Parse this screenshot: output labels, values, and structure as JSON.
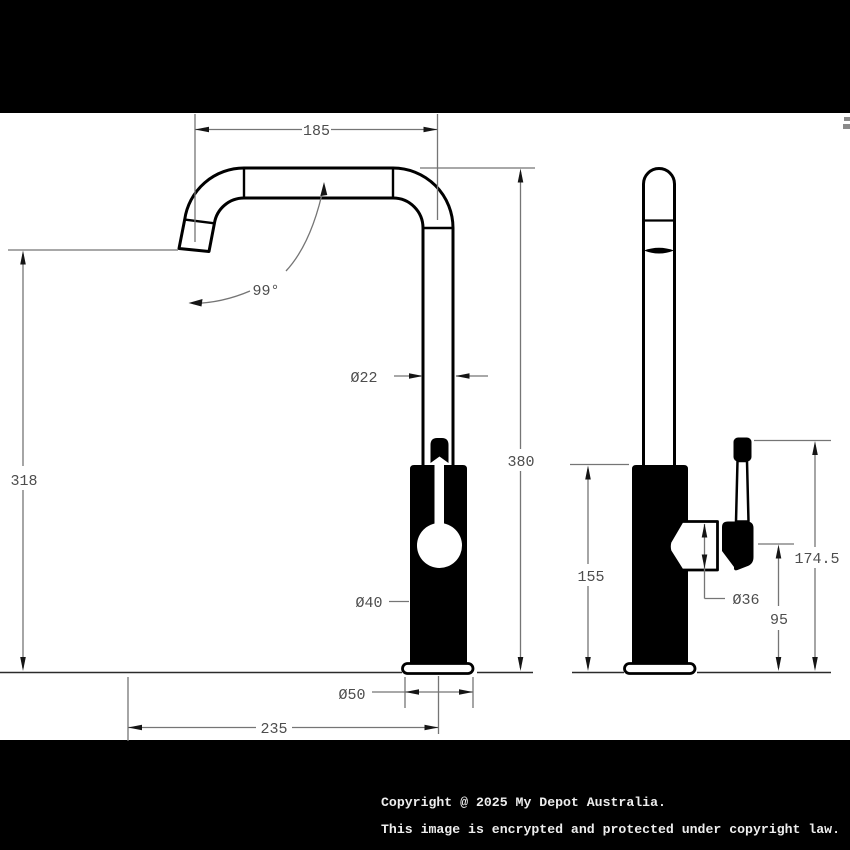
{
  "dimensions": {
    "spout_width": "185",
    "spout_angle": "99°",
    "pipe_diameter": "Ø22",
    "overall_height": "380",
    "spout_outlet_height": "318",
    "body_diameter": "Ø40",
    "base_diameter": "Ø50",
    "spout_reach": "235",
    "body_height": "155",
    "handle_diameter": "Ø36",
    "handle_pivot_height": "95",
    "handle_top_height": "174.5"
  },
  "footer": {
    "line1": "Copyright @ 2025 My Depot Australia.",
    "line2": "This image is encrypted and protected under copyright law."
  },
  "colors": {
    "background": "#000000",
    "paper": "#ffffff",
    "object_line": "#000000",
    "dimension_line": "#757575",
    "dimension_text": "#4d4d4d",
    "footer_text": "#ededed"
  }
}
